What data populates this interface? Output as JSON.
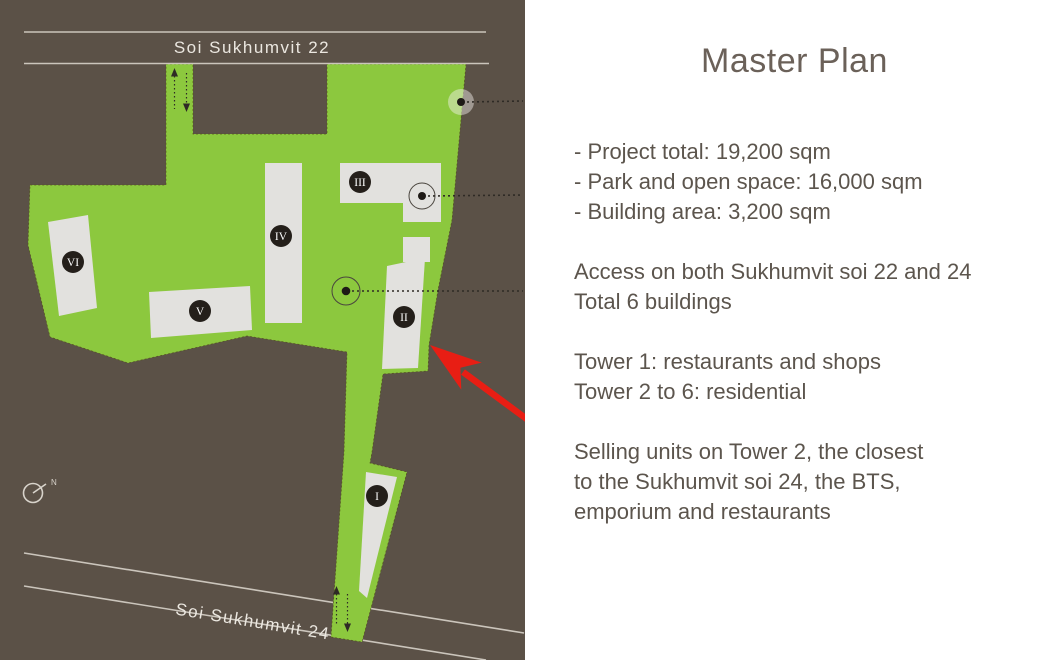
{
  "panel": {
    "title": "Master Plan",
    "groups": [
      {
        "lines": [
          "- Project total: 19,200 sqm",
          "- Park and open space: 16,000 sqm",
          "- Building area: 3,200 sqm"
        ]
      },
      {
        "lines": [
          "Access on both Sukhumvit soi 22 and 24",
          "Total 6 buildings"
        ]
      },
      {
        "lines": [
          "Tower 1: restaurants and shops",
          "Tower 2 to 6: residential"
        ]
      },
      {
        "lines": [
          "Selling units on Tower 2, the closest",
          "to the Sukhumvit soi 24, the BTS,",
          "emporium and restaurants"
        ]
      }
    ]
  },
  "map": {
    "road_top": {
      "label": "Soi Sukhumvit 22"
    },
    "road_bottom": {
      "label": "Soi Sukhumvit 24"
    },
    "compass": {
      "label": "N"
    },
    "buildings": [
      {
        "id": "tower-1",
        "label": "I"
      },
      {
        "id": "tower-2",
        "label": "II"
      },
      {
        "id": "tower-3",
        "label": "III"
      },
      {
        "id": "tower-4",
        "label": "IV"
      },
      {
        "id": "tower-5",
        "label": "V"
      },
      {
        "id": "tower-6",
        "label": "VI"
      }
    ],
    "colors": {
      "ground": "#5b5147",
      "park_green": "#8cc83e",
      "building_fill": "#e2e1de",
      "road_line": "#cbc5bc",
      "road_text": "#ebe7e0",
      "marker_red": "#e81e14",
      "label_circle": "#241f1a"
    }
  }
}
